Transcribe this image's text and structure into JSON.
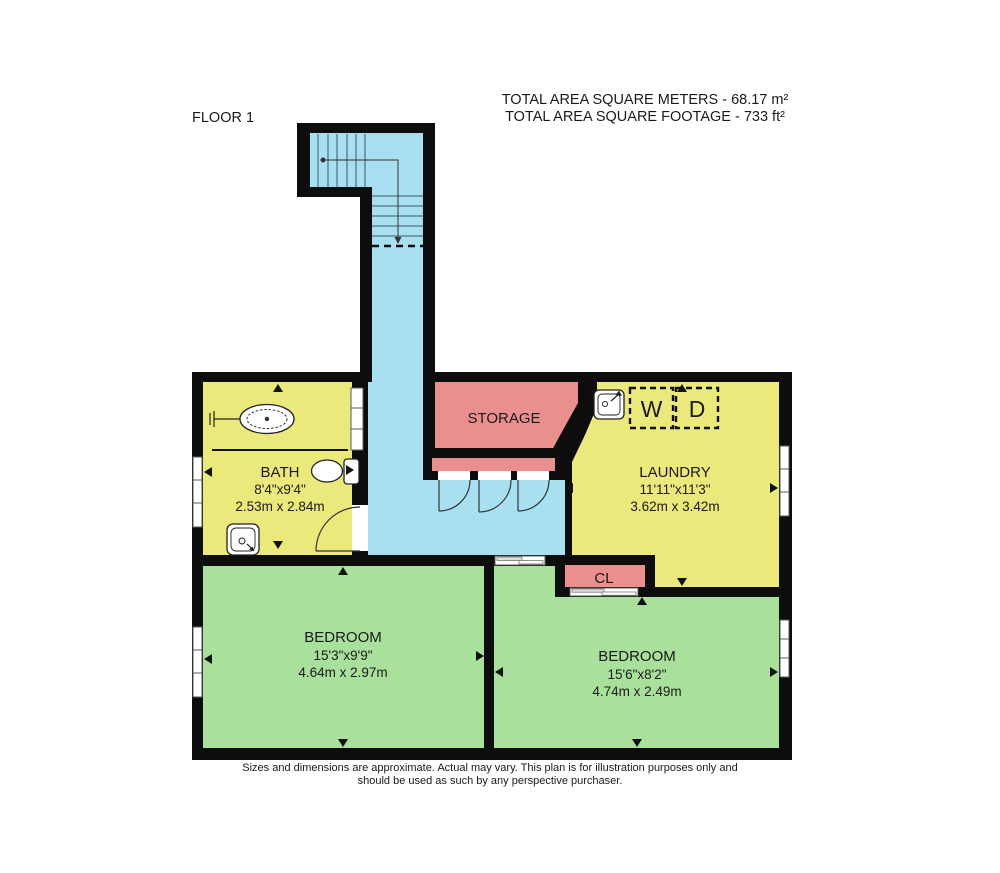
{
  "header": {
    "floor_label": "FLOOR 1",
    "area_line1": "TOTAL AREA SQUARE METERS - 68.17 m²",
    "area_line2": "TOTAL AREA SQUARE FOOTAGE - 733 ft²"
  },
  "rooms": {
    "bath": {
      "name": "BATH",
      "dims_ft": "8'4\"x9'4\"",
      "dims_m": "2.53m x 2.84m"
    },
    "storage": {
      "name": "STORAGE"
    },
    "laundry": {
      "name": "LAUNDRY",
      "dims_ft": "11'11\"x11'3\"",
      "dims_m": "3.62m x 3.42m"
    },
    "closet": {
      "name": "CL"
    },
    "bedroom_left": {
      "name": "BEDROOM",
      "dims_ft": "15'3\"x9'9\"",
      "dims_m": "4.64m x 2.97m"
    },
    "bedroom_right": {
      "name": "BEDROOM",
      "dims_ft": "15'6\"x8'2\"",
      "dims_m": "4.74m x 2.49m"
    }
  },
  "appliances": {
    "washer_label": "W",
    "dryer_label": "D"
  },
  "footer": {
    "line1": "Sizes and dimensions are approximate. Actual may vary. This plan is for illustration purposes only and",
    "line2": "should be used as such by any perspective purchaser."
  },
  "icons": [
    "bathtub-icon",
    "toilet-icon",
    "bath-sink-icon",
    "laundry-sink-icon",
    "washer-box-icon",
    "dryer-box-icon",
    "staircase-icon",
    "window-icon",
    "door-swing-icon",
    "sliding-door-icon",
    "direction-arrow-icon"
  ],
  "colors": {
    "yellow": "#ece97c",
    "green": "#a9e09c",
    "pink": "#e98f8e",
    "blue": "#a8dff1",
    "wall": "#0d0d0d",
    "text_color": "#1a1a1a"
  }
}
